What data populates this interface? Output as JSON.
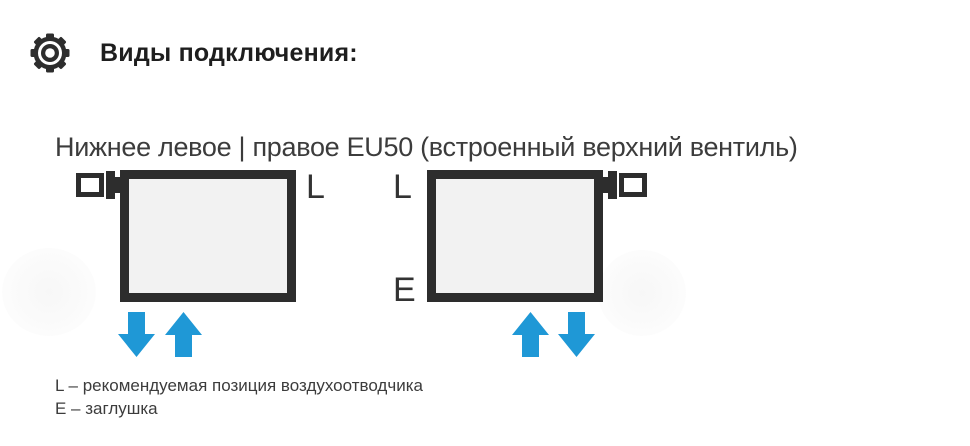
{
  "header": {
    "title": "Виды подключения:"
  },
  "section": {
    "subtitle": "Нижнее левое | правое EU50 (встроенный верхний вентиль)",
    "diagrams": [
      {
        "id": "bottom-left-connection",
        "valve_position": "top-left",
        "labels": {
          "top": "L"
        },
        "arrows": [
          "down",
          "up"
        ]
      },
      {
        "id": "bottom-right-connection",
        "valve_position": "top-right",
        "labels": {
          "top": "L",
          "bottom": "E"
        },
        "arrows": [
          "up",
          "down"
        ]
      }
    ],
    "legend": {
      "line1": "L – рекомендуемая позиция воздухоотводчика",
      "line2": "E – заглушка"
    }
  },
  "colors": {
    "ink": "#2d2d2d",
    "arrow": "#1f98d6",
    "radiator-fill": "#f2f2f2",
    "text": "#3c3c3c",
    "title": "#1e1e1e"
  }
}
